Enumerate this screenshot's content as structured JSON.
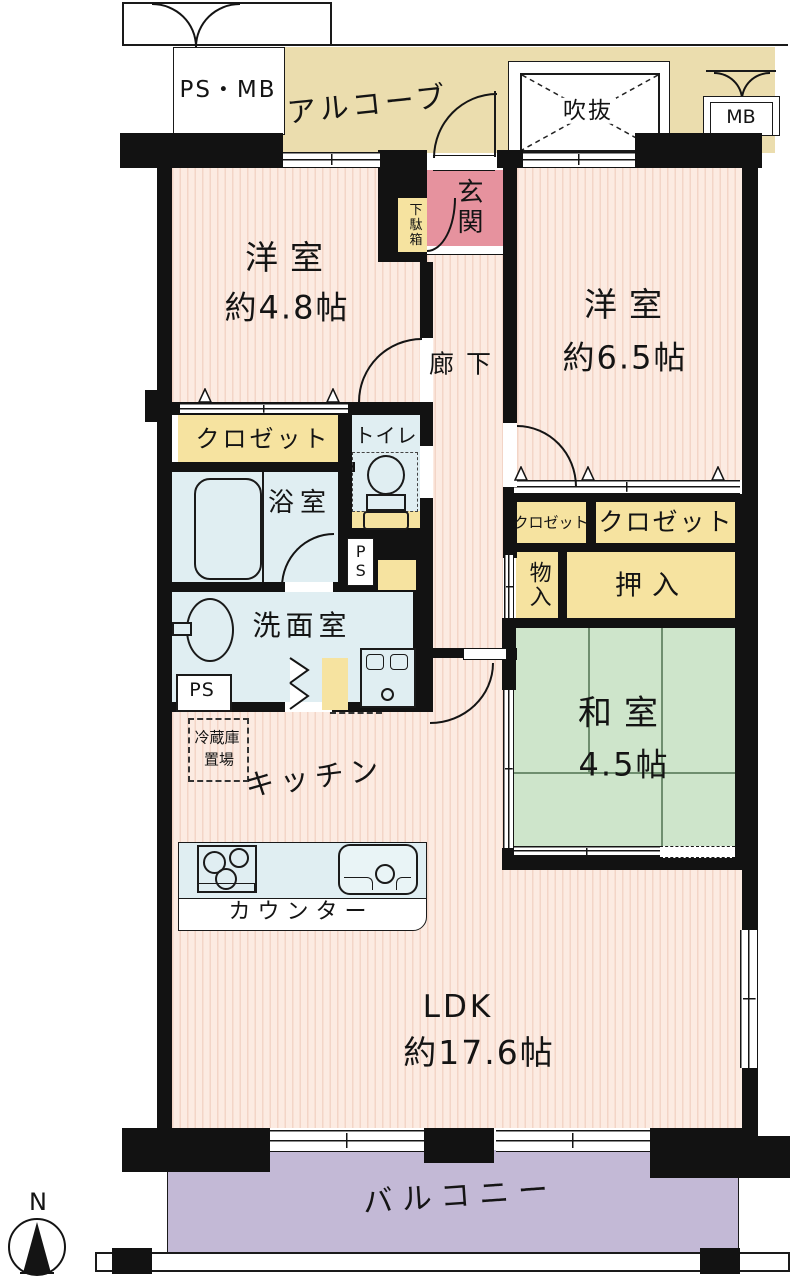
{
  "labels": {
    "ps_mb": "PS・MB",
    "alcove": "アルコーブ",
    "void": "吹抜",
    "mb": "MB",
    "genkan": "玄関",
    "shoe_box": "下駄箱",
    "bedroom1_name": "洋室",
    "bedroom1_size": "約4.8帖",
    "hallway": "廊下",
    "bedroom2_name": "洋室",
    "bedroom2_size": "約6.5帖",
    "closet_west": "クロゼット",
    "toilet": "トイレ",
    "bath": "浴室",
    "ps_toilet": "PS",
    "closet_small": "クロゼット",
    "closet_large": "クロゼット",
    "storage": "物入",
    "oshiire": "押入",
    "washroom": "洗面室",
    "ps_washroom": "PS",
    "washitsu_name": "和室",
    "washitsu_size": "4.5帖",
    "fridge_line1": "冷蔵庫",
    "fridge_line2": "置場",
    "kitchen": "キッチン",
    "counter": "カウンター",
    "ldk_name": "LDK",
    "ldk_size": "約17.6帖",
    "balcony": "バルコニー",
    "compass_north": "N"
  },
  "colors": {
    "wall": "#121212",
    "room_pink": "#fcebe2",
    "room_pink_stripe": "#f3d5c7",
    "genkan_pink": "#e6929e",
    "closet_yellow": "#f6e3a0",
    "alcove_beige": "#ebddae",
    "tatami_green": "#cee5cb",
    "wet_area_blue": "#e0eef2",
    "balcony_purple": "#c3b9d6"
  }
}
